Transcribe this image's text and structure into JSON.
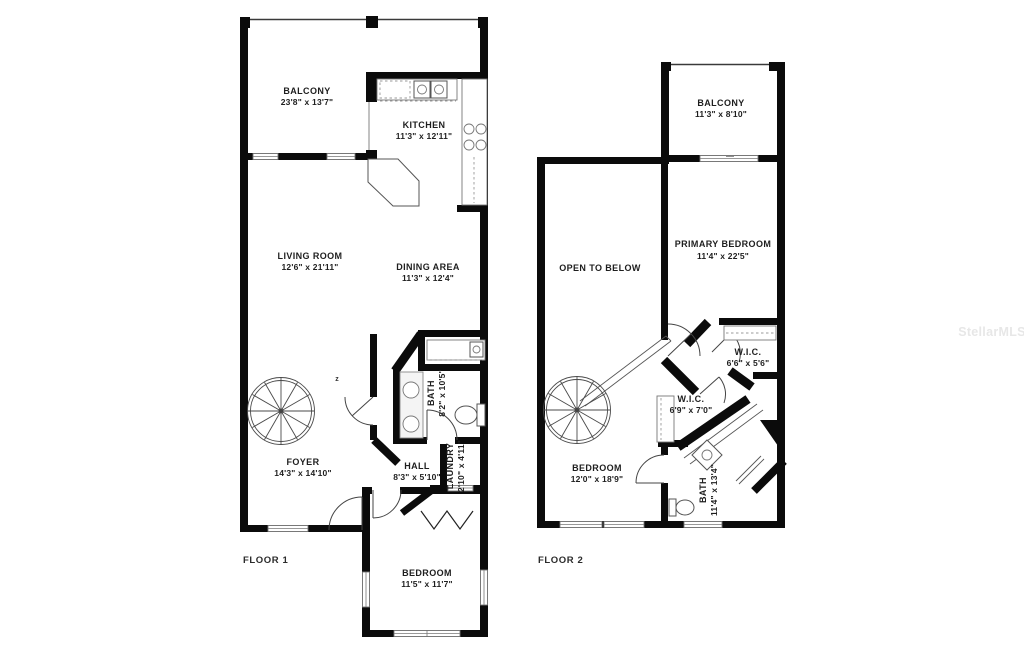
{
  "watermark": "StellarMLS",
  "floor1": {
    "label": "FLOOR 1",
    "compass_mark": "z",
    "rooms": {
      "balcony": {
        "name": "BALCONY",
        "dims": "23'8\" x 13'7\""
      },
      "kitchen": {
        "name": "KITCHEN",
        "dims": "11'3\" x 12'11\""
      },
      "living": {
        "name": "LIVING ROOM",
        "dims": "12'6\" x 21'11\""
      },
      "dining": {
        "name": "DINING AREA",
        "dims": "11'3\" x 12'4\""
      },
      "bath": {
        "name": "BATH",
        "dims": "8'2\" x 10'5\""
      },
      "foyer": {
        "name": "FOYER",
        "dims": "14'3\" x 14'10\""
      },
      "hall": {
        "name": "HALL",
        "dims": "8'3\" x 5'10\""
      },
      "laundry": {
        "name": "LAUNDRY",
        "dims": "2'10\" x 4'11\""
      },
      "bedroom": {
        "name": "BEDROOM",
        "dims": "11'5\" x 11'7\""
      }
    }
  },
  "floor2": {
    "label": "FLOOR 2",
    "rooms": {
      "balcony": {
        "name": "BALCONY",
        "dims": "11'3\" x 8'10\""
      },
      "open": {
        "name": "OPEN TO BELOW"
      },
      "primary": {
        "name": "PRIMARY BEDROOM",
        "dims": "11'4\" x 22'5\""
      },
      "wic1": {
        "name": "W.I.C.",
        "dims": "6'6\" x 5'6\""
      },
      "wic2": {
        "name": "W.I.C.",
        "dims": "6'9\" x 7'0\""
      },
      "bedroom": {
        "name": "BEDROOM",
        "dims": "12'0\" x 18'9\""
      },
      "bath": {
        "name": "BATH",
        "dims": "11'4\" x 13'4\""
      }
    }
  }
}
